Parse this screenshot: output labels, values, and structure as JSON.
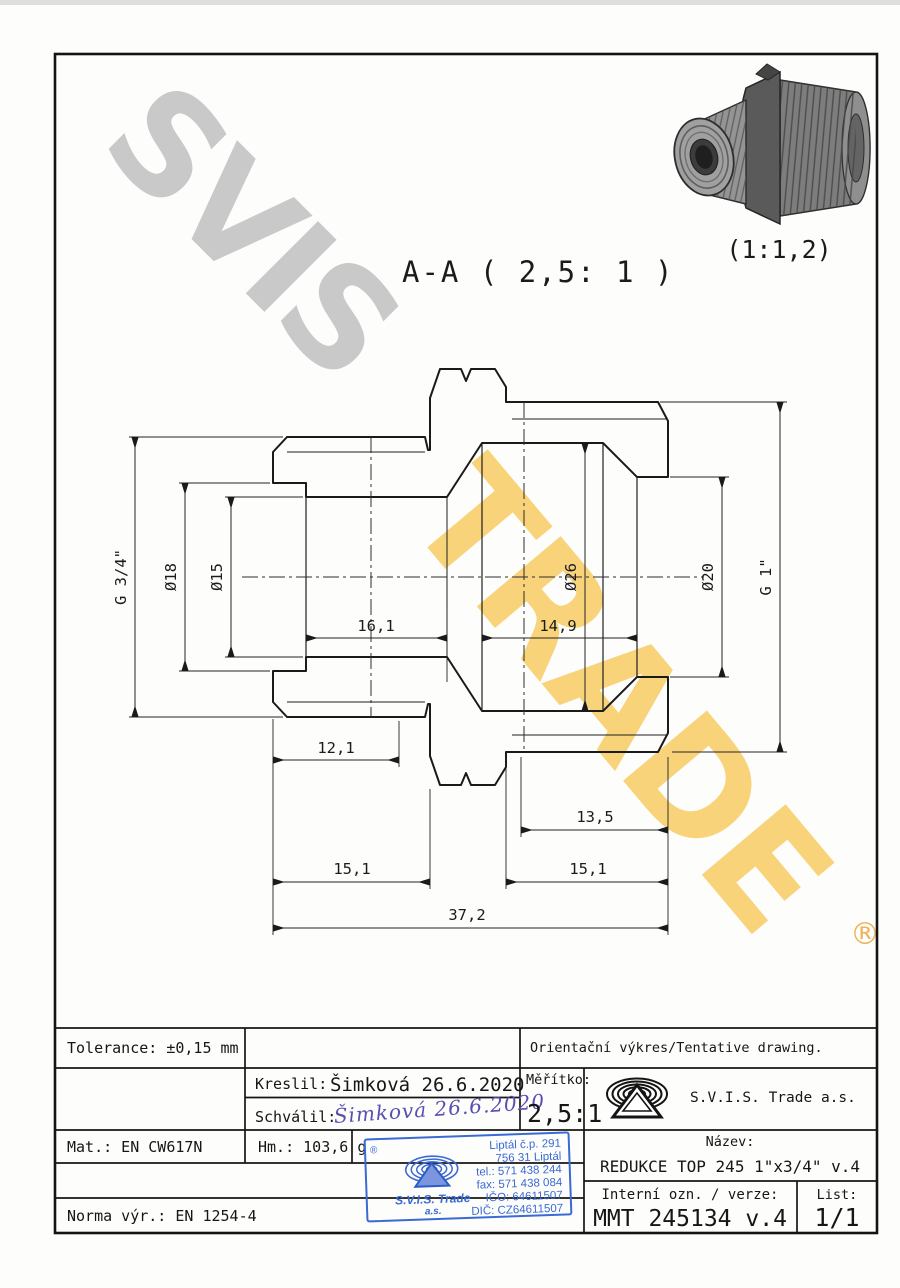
{
  "watermark": {
    "word_gray": "SVIS",
    "word_yellow": "TRADE",
    "registered_mark": "®",
    "gray_color": "#c9c9c9",
    "yellow_color": "#f8cb5e",
    "orange_color": "#eda742"
  },
  "drawing_view": {
    "section_title": "A-A ( 2,5: 1 )",
    "thumbnail_scale": "(1:1,2)"
  },
  "dimensions": {
    "thread_left": "G 3/4\"",
    "dia_18": "Ø18",
    "dia_15": "Ø15",
    "dia_26": "Ø26",
    "dia_20": "Ø20",
    "thread_right": "G 1\"",
    "depth_left_bore": "16,1",
    "depth_right_bore": "14,9",
    "len_thread_left": "12,1",
    "len_thread_right": "13,5",
    "len_left_end": "15,1",
    "len_right_end": "15,1",
    "len_total": "37,2"
  },
  "title_block": {
    "tolerance": "Tolerance: ±0,15 mm",
    "orientation_note": "Orientační výkres/Tentative drawing.",
    "drawn_label": "Kreslil:",
    "drawn_value": "Šimková 26.6.2020",
    "approved_label": "Schválil:",
    "approved_signature": "Šimková 26.6.2020",
    "scale_label": "Měřítko:",
    "scale_value": "2,5:1",
    "company": "S.V.I.S. Trade a.s.",
    "material": "Mat.: EN CW617N",
    "weight": "Hm.: 103,6 g",
    "standard": "Norma výr.: EN 1254-4",
    "name_label": "Název:",
    "name_value": "REDUKCE TOP 245 1\"x3/4\" v.4",
    "internal_label": "Interní ozn. / verze:",
    "internal_value": "MMT 245134 v.4",
    "sheet_label": "List:",
    "sheet_value": "1/1"
  },
  "stamp": {
    "registered_mark": "®",
    "company_line1": "S.V.I.S. Trade",
    "company_line2": "a.s.",
    "address_line1": "Liptál č.p. 291",
    "address_line2": "756 31 Liptál",
    "tel": "tel.: 571 438 244",
    "fax": "fax: 571 438 084",
    "ico": "IČO: 64611507",
    "dic": "DIČ: CZ64611507",
    "color": "#3a6ad4"
  }
}
